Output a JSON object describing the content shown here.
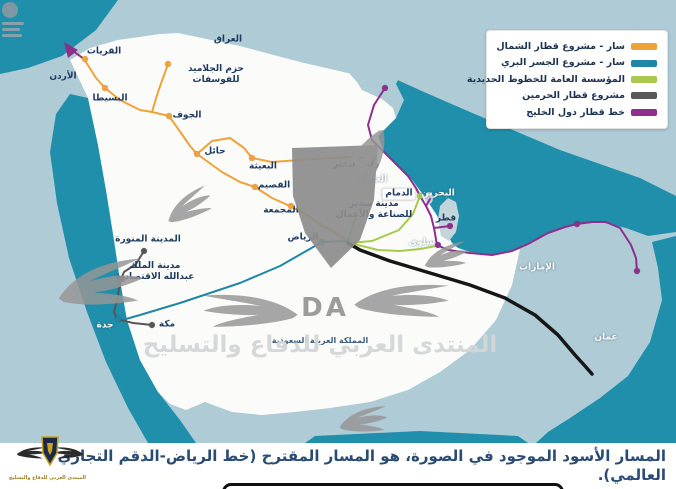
{
  "legend": {
    "items": [
      {
        "key": "nsr",
        "label": "سار - مشروع قطار الشمال",
        "color": "#f0a23a"
      },
      {
        "key": "landbridge",
        "label": "سار - مشروع الجسر البري",
        "color": "#1f87a6"
      },
      {
        "key": "sro",
        "label": "المؤسسة العامة للخطوط الحديدية",
        "color": "#a8c94e"
      },
      {
        "key": "haramain",
        "label": "مشروع قطار الحرمين",
        "color": "#595959"
      },
      {
        "key": "gcc",
        "label": "خط قطار دول الخليج",
        "color": "#8e2f8e"
      }
    ]
  },
  "caption": {
    "text": "المسار الأسود الموجود في الصورة، هو المسار المقترح (خط الرياض-الدقم التجاري العالمي)."
  },
  "watermark": {
    "center_text": "المنتدى العربي للدفاع والتسليح",
    "logo_text": "DA",
    "bottom_text": "المنتدى العربي للدفاع والتسليح"
  },
  "map": {
    "colors": {
      "sea": "#1f8fab",
      "land": "#aecbd6",
      "saudi": "#fbfcfa",
      "label_dark": "#1e3a5f",
      "label_white": "#ffffff",
      "label_ksa": "#3e5f80"
    },
    "line_colors": {
      "nsr": "#f0a23a",
      "landbridge": "#1f87a6",
      "sro": "#a8c94e",
      "haramain": "#565656",
      "gcc": "#8e2f8e",
      "proposed": "#161616"
    },
    "labels": [
      {
        "text": "العراق",
        "x": 228,
        "y": 40,
        "c": "dark"
      },
      {
        "text": "الأردن",
        "x": 63,
        "y": 77,
        "c": "dark"
      },
      {
        "text": "القريات",
        "x": 104,
        "y": 52,
        "c": "dark",
        "dot": [
          85,
          59,
          "nsr"
        ]
      },
      {
        "text": "حزم الجلاميد\nللفوسفات",
        "x": 216,
        "y": 75,
        "c": "dark",
        "dot": [
          168,
          64,
          "nsr"
        ]
      },
      {
        "text": "البسيطا",
        "x": 110,
        "y": 99,
        "c": "dark",
        "dot": [
          105,
          88,
          "nsr"
        ]
      },
      {
        "text": "الجوف",
        "x": 187,
        "y": 116,
        "c": "dark",
        "dot": [
          169,
          116,
          "nsr"
        ]
      },
      {
        "text": "حائل",
        "x": 215,
        "y": 152,
        "c": "dark",
        "dot": [
          197,
          154,
          "nsr"
        ]
      },
      {
        "text": "البعيثة",
        "x": 263,
        "y": 167,
        "c": "dark",
        "dot": [
          252,
          158,
          "nsr"
        ]
      },
      {
        "text": "القصيم",
        "x": 274,
        "y": 186,
        "c": "dark",
        "dot": [
          255,
          187,
          "nsr"
        ]
      },
      {
        "text": "المجمعة",
        "x": 281,
        "y": 211,
        "c": "dark",
        "dot": [
          291,
          206,
          "nsr"
        ]
      },
      {
        "text": "رأس الخير",
        "x": 356,
        "y": 165,
        "c": "dark"
      },
      {
        "text": "الجبيل",
        "x": 373,
        "y": 180,
        "c": "white"
      },
      {
        "text": "الدمام",
        "x": 399,
        "y": 194,
        "c": "dark",
        "box": true,
        "dot": [
          420,
          196,
          "sro"
        ]
      },
      {
        "text": "البحرين",
        "x": 438,
        "y": 194,
        "c": "white"
      },
      {
        "text": "قطر",
        "x": 446,
        "y": 219,
        "c": "dark",
        "dot": [
          450,
          226,
          "gcc"
        ]
      },
      {
        "text": "سلوى",
        "x": 422,
        "y": 243,
        "c": "white",
        "dot": [
          438,
          245,
          "gcc"
        ]
      },
      {
        "text": "مدينة سدير\nللصناعة والأعمال",
        "x": 374,
        "y": 210,
        "c": "dark"
      },
      {
        "text": "الرياض",
        "x": 303,
        "y": 238,
        "c": "dark",
        "dot": [
          322,
          242,
          "landbridge"
        ]
      },
      {
        "text": "المدينة المنورة",
        "x": 148,
        "y": 240,
        "c": "dark",
        "dot": [
          144,
          251,
          "haramain"
        ]
      },
      {
        "text": "مدينة الملك\nعبدالله الاقتصادية",
        "x": 155,
        "y": 272,
        "c": "dark",
        "dot": [
          122,
          279,
          "haramain"
        ]
      },
      {
        "text": "جدة",
        "x": 105,
        "y": 326,
        "c": "white",
        "dot": [
          118,
          319,
          "landbridge"
        ]
      },
      {
        "text": "مكة",
        "x": 167,
        "y": 325,
        "c": "dark",
        "dot": [
          152,
          325,
          "haramain"
        ]
      },
      {
        "text": "الإمارات",
        "x": 537,
        "y": 268,
        "c": "white"
      },
      {
        "text": "عمان",
        "x": 606,
        "y": 338,
        "c": "white"
      },
      {
        "text": "المملكة العربية السعودية",
        "x": 320,
        "y": 341,
        "c": "ksa"
      }
    ],
    "extra_dots": [
      [
        385,
        88,
        "gcc"
      ],
      [
        577,
        224,
        "gcc"
      ],
      [
        637,
        271,
        "gcc"
      ],
      [
        372,
        158,
        "nsr"
      ]
    ]
  }
}
